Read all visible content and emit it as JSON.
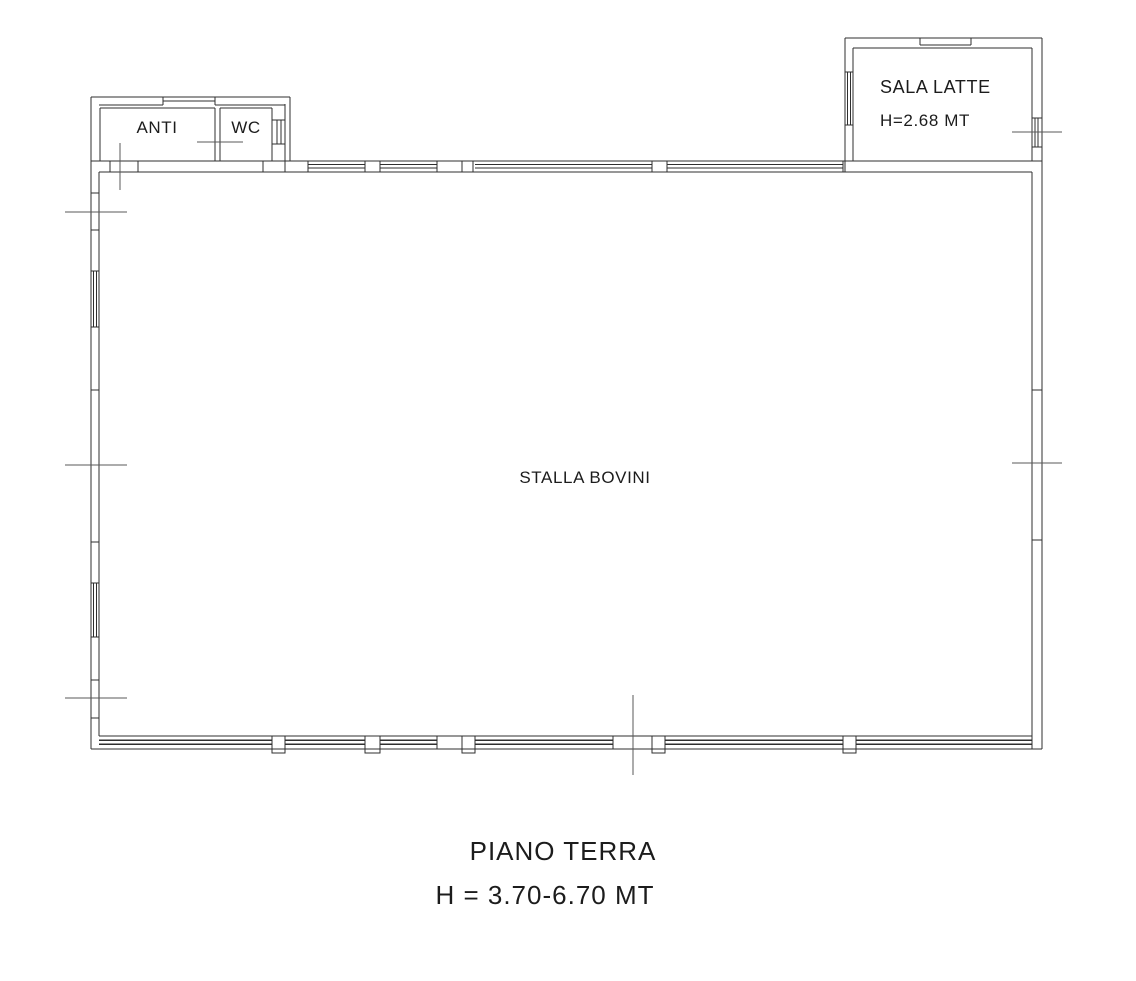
{
  "rooms": {
    "anti": "ANTI",
    "wc": "WC",
    "sala_latte": "SALA LATTE",
    "sala_latte_height": "H=2.68 MT",
    "stalla_bovini": "STALLA BOVINI"
  },
  "caption": {
    "floor": "PIANO TERRA",
    "height": "H = 3.70-6.70 MT"
  },
  "colors": {
    "background": "#ffffff",
    "wall_line": "#2f2f2f",
    "tick_line": "#5a5a5a",
    "text": "#1c1c1c"
  }
}
